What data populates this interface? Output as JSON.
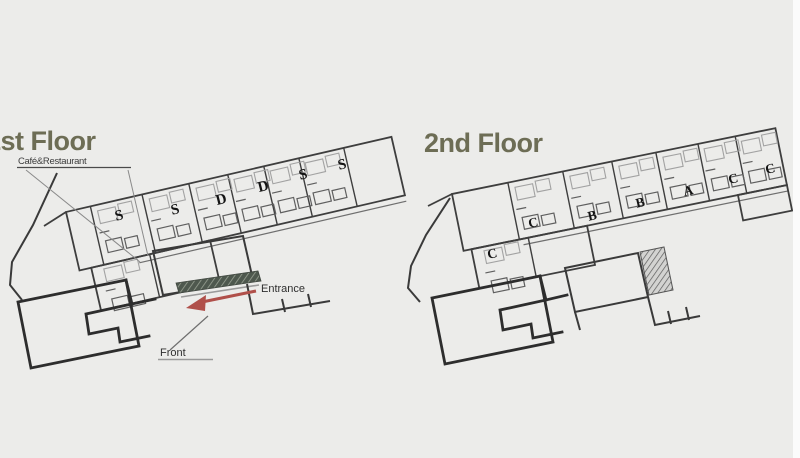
{
  "diagram": {
    "type": "hotel-floor-plan",
    "floors": 2
  },
  "colors": {
    "background": "#ececea",
    "title": "#6d6d55",
    "wall": "#3e3e3e",
    "wall_heavy": "#2d2d2d",
    "detail": "#a2a2a2",
    "accent_red": "#b0504a",
    "hatch_dark": "#4e584e",
    "hatch_gray": "#5a5a5a"
  },
  "floor1": {
    "title": "1st Floor",
    "cafe_label": "Café&Restaurant",
    "entrance_label": "Entrance",
    "front_label": "Front",
    "rooms": [
      "S",
      "S",
      "D",
      "D",
      "S",
      "S"
    ]
  },
  "floor2": {
    "title": "2nd Floor",
    "rooms": [
      "C",
      "C",
      "B",
      "B",
      "A",
      "C",
      "C"
    ]
  }
}
